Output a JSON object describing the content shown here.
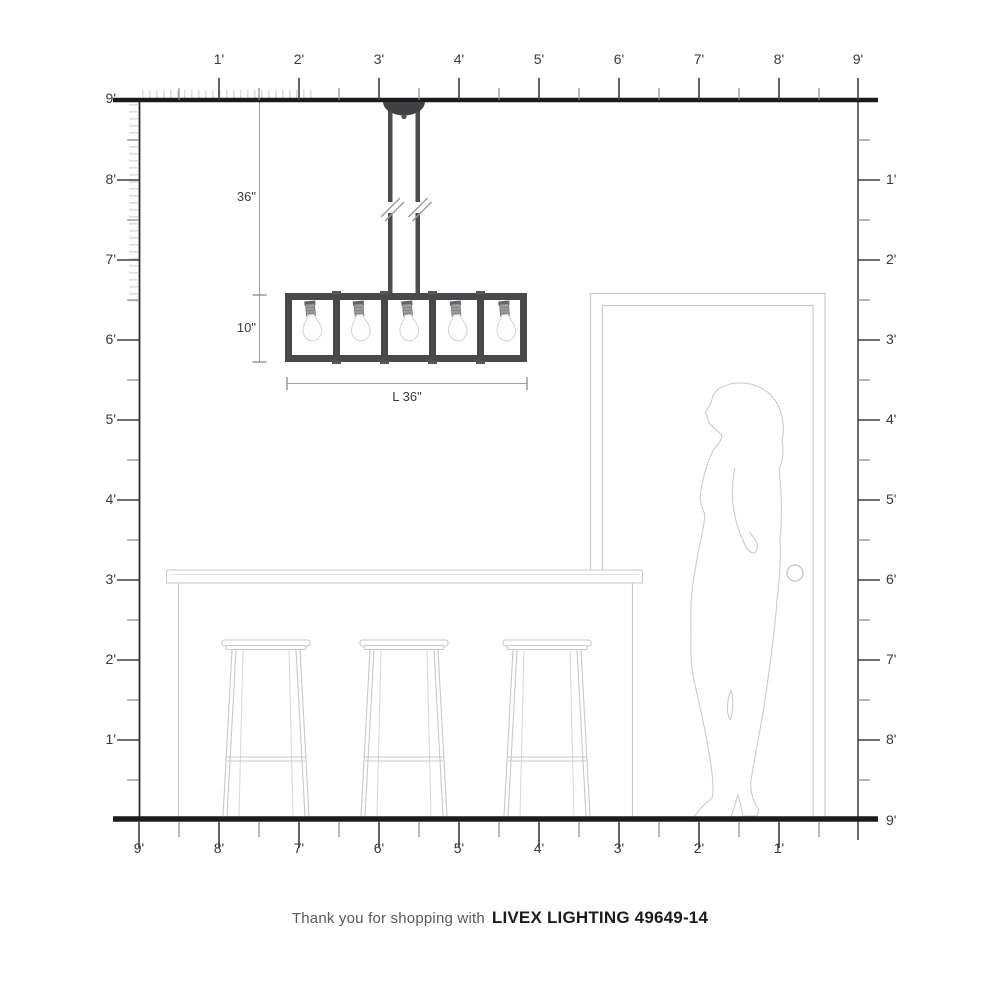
{
  "title": "Room scale diagram for linear chandelier",
  "rulers": {
    "top": [
      "1'",
      "2'",
      "3'",
      "4'",
      "5'",
      "6'",
      "7'",
      "8'",
      "9'"
    ],
    "left": [
      "9'",
      "8'",
      "7'",
      "6'",
      "5'",
      "4'",
      "3'",
      "2'",
      "1'"
    ],
    "right": [
      "1'",
      "2'",
      "3'",
      "4'",
      "5'",
      "6'",
      "7'",
      "8'"
    ],
    "right_floor": "9'",
    "bottom": [
      "9'",
      "8'",
      "7'",
      "6'",
      "5'",
      "4'",
      "3'",
      "2'",
      "1'"
    ]
  },
  "dimensions": {
    "drop": "36\"",
    "fixture_height": "10\"",
    "fixture_length": "L 36\""
  },
  "scene": {
    "fixture": "5-light linear cage chandelier",
    "elements": [
      "ceiling-canopy",
      "downrods",
      "break-marks",
      "cage-frame",
      "bulbs",
      "door",
      "woman-silhouette",
      "kitchen-island",
      "bar-stools"
    ]
  },
  "footer": {
    "prefix": "Thank you for shopping with",
    "product": "LIVEX LIGHTING 49649-14"
  },
  "colors": {
    "structure_line": "#1b1b1b",
    "fixture_gray": "#49494c",
    "outline_light": "#c8cacc",
    "dimension_line": "#a0a0a0",
    "text": "#3a3a3a"
  }
}
